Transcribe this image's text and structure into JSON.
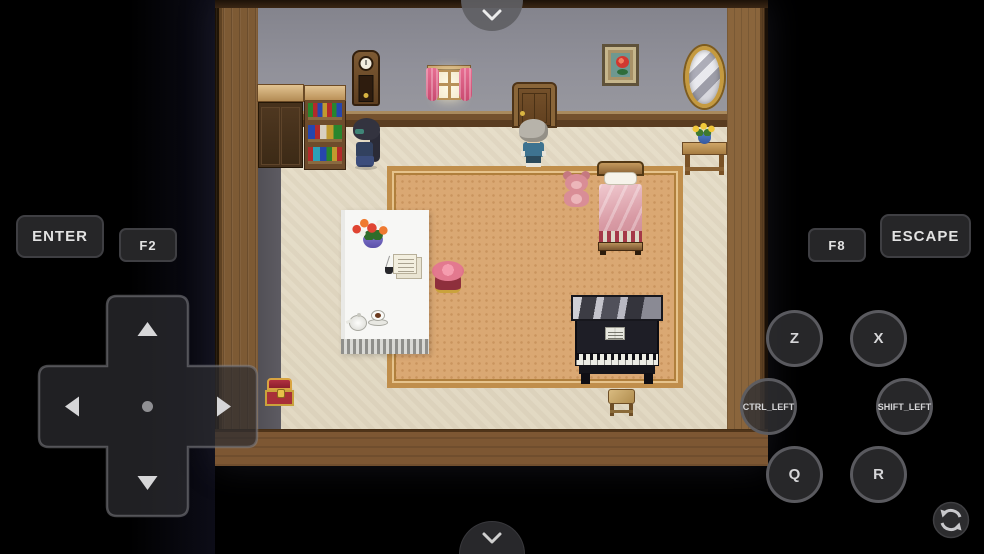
{
  "emulator": {
    "rect_buttons": {
      "enter": "ENTER",
      "f2": "F2",
      "f8": "F8",
      "escape": "ESCAPE"
    },
    "circle_buttons": {
      "z": "Z",
      "x": "X",
      "ctrl_left": "CTRL_LEFT",
      "shift_left": "SHIFT_LEFT",
      "q": "Q",
      "r": "R"
    },
    "icons": {
      "top_toggle": "chevron-down",
      "bottom_toggle": "chevron-down",
      "rotate": "rotate-screen",
      "dpad_directions": [
        "up",
        "left",
        "right",
        "down"
      ]
    },
    "colors": {
      "background": "#000000",
      "button_fill": "#262628",
      "button_border": "#3f3f43",
      "button_text": "#e2e2e2"
    }
  },
  "game": {
    "scene": "rpg-bedroom-interior",
    "objects": [
      "wardrobe",
      "bookshelf",
      "grandfather-clock",
      "curtained-window",
      "door",
      "rose-picture",
      "gold-mirror",
      "flower-side-table",
      "npc-dark-haired",
      "npc-gray-haired",
      "teddy-bear",
      "bed",
      "carpet",
      "white-table",
      "flower-vase",
      "letters-and-quill",
      "tea-set",
      "pink-stool",
      "piano",
      "wooden-stool",
      "treasure-chest"
    ],
    "colors": {
      "floor": "#e4dbc6",
      "wall": "#8e8e97",
      "wood": "#7a5630",
      "carpet": "#daa873"
    }
  }
}
